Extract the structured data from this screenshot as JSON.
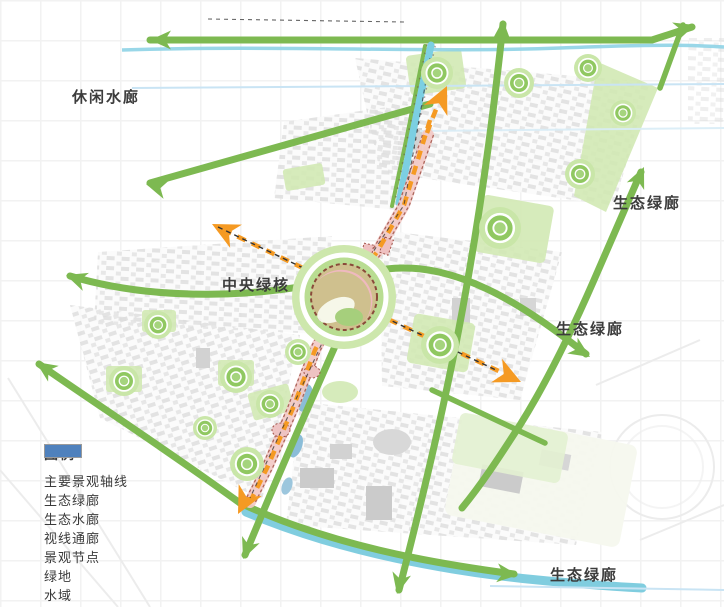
{
  "map": {
    "labels": {
      "leisure_water_corridor": "休闲水廊",
      "central_green_core": "中央绿核",
      "eco_green_corridor_ne": "生态绿廊",
      "eco_green_corridor_e": "生态绿廊",
      "eco_green_corridor_s": "生态绿廊"
    },
    "core": {
      "x": 344,
      "y": 297
    },
    "nodes": [
      {
        "x": 437,
        "y": 73,
        "r": 16
      },
      {
        "x": 519,
        "y": 83,
        "r": 15
      },
      {
        "x": 588,
        "y": 68,
        "r": 14
      },
      {
        "x": 623,
        "y": 113,
        "r": 13
      },
      {
        "x": 580,
        "y": 174,
        "r": 15
      },
      {
        "x": 500,
        "y": 228,
        "r": 21
      },
      {
        "x": 440,
        "y": 345,
        "r": 19
      },
      {
        "x": 298,
        "y": 352,
        "r": 13
      },
      {
        "x": 158,
        "y": 325,
        "r": 14
      },
      {
        "x": 124,
        "y": 381,
        "r": 15
      },
      {
        "x": 236,
        "y": 377,
        "r": 16
      },
      {
        "x": 205,
        "y": 428,
        "r": 12
      },
      {
        "x": 270,
        "y": 404,
        "r": 14
      },
      {
        "x": 247,
        "y": 464,
        "r": 17
      }
    ],
    "colors": {
      "corridor_green": "#7db951",
      "node_green": "#8cc152",
      "green_space": "#d2e9b4",
      "water_cyan": "#7ccfe2",
      "water_blue": "#4f81bd",
      "axis_orange": "#f59a23",
      "axis_pink": "#f2c9c6",
      "axis_outline": "#a05248",
      "sightline_black": "#333333",
      "label_text": "#3c3c3c"
    }
  },
  "legend": {
    "title": "图例",
    "items": [
      {
        "key": "main-landscape-axis",
        "label": "主要景观轴线"
      },
      {
        "key": "eco-green-corridor",
        "label": "生态绿廊"
      },
      {
        "key": "eco-water-corridor",
        "label": "生态水廊"
      },
      {
        "key": "sight-corridor",
        "label": "视线通廊"
      },
      {
        "key": "landscape-node",
        "label": "景观节点"
      },
      {
        "key": "green-space",
        "label": "绿地"
      },
      {
        "key": "water-area",
        "label": "水域"
      }
    ]
  }
}
